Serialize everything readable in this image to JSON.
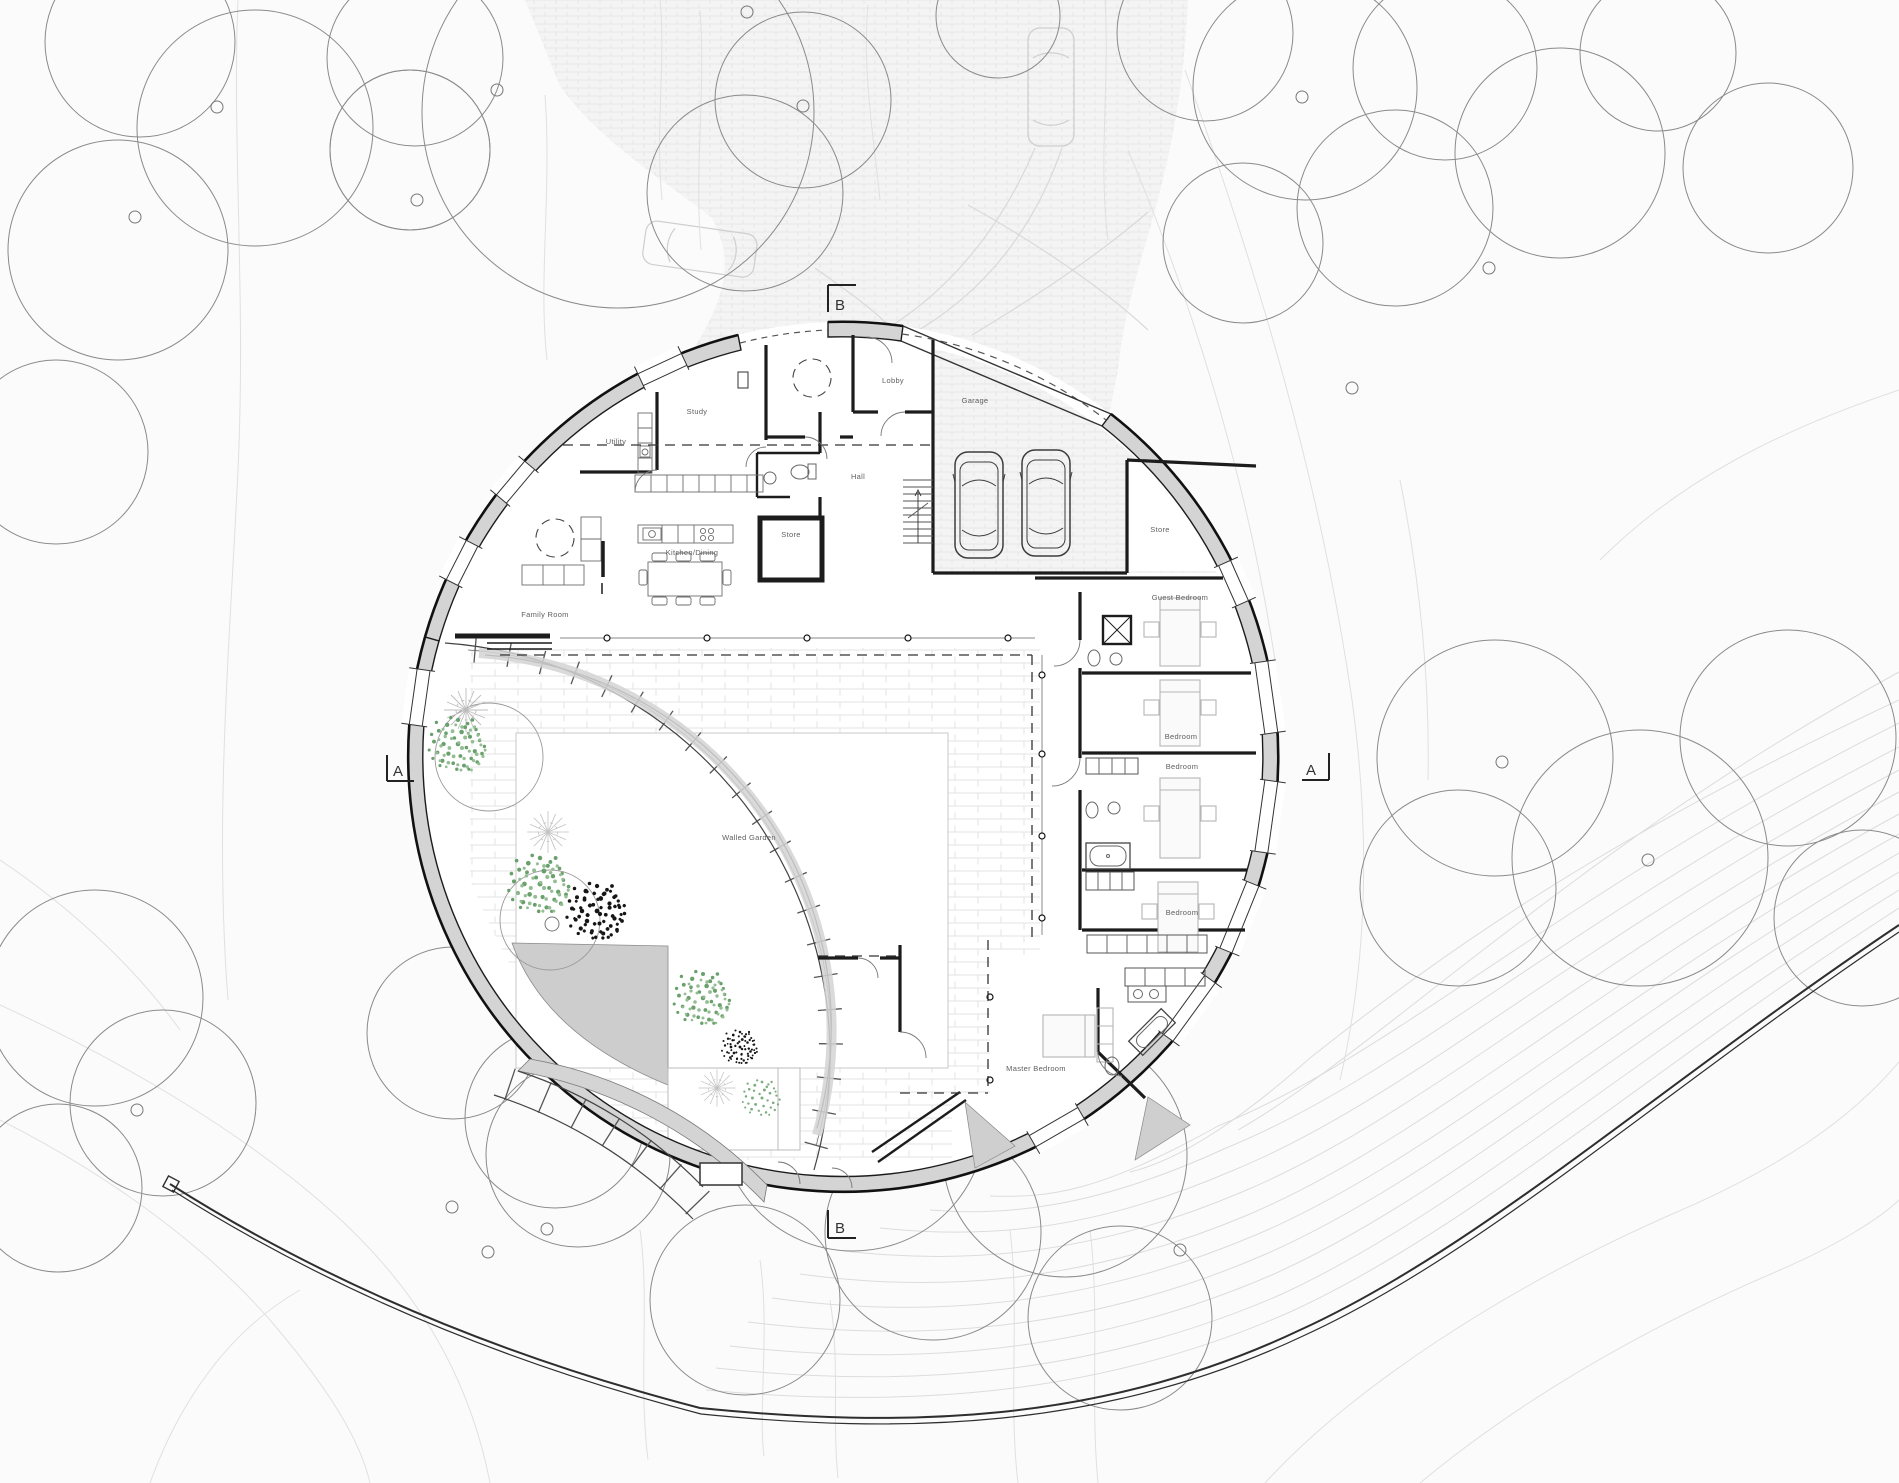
{
  "plan": {
    "rooms": [
      {
        "label": "Study"
      },
      {
        "label": "Utility"
      },
      {
        "label": "Lobby"
      },
      {
        "label": "Garage"
      },
      {
        "label": "Hall"
      },
      {
        "label": "Store"
      },
      {
        "label": "Store"
      },
      {
        "label": "Kitchen/Dining"
      },
      {
        "label": "Family Room"
      },
      {
        "label": "Guest Bedroom"
      },
      {
        "label": "Bedroom"
      },
      {
        "label": "Bedroom"
      },
      {
        "label": "Bedroom"
      },
      {
        "label": "Master Bedroom"
      },
      {
        "label": "Walled Garden"
      }
    ],
    "section_markers": [
      {
        "label": "B"
      },
      {
        "label": "B"
      },
      {
        "label": "A"
      },
      {
        "label": "A"
      }
    ],
    "colors": {
      "wall_poche": "#d4d4d4",
      "wall_line": "#1c1c1c",
      "contour": "#e0e0e0",
      "tree_canopy": "#8a8a8a",
      "foliage_green": "#6aa06c",
      "foliage_dark": "#161616",
      "paving": "#f4f4f4"
    }
  }
}
